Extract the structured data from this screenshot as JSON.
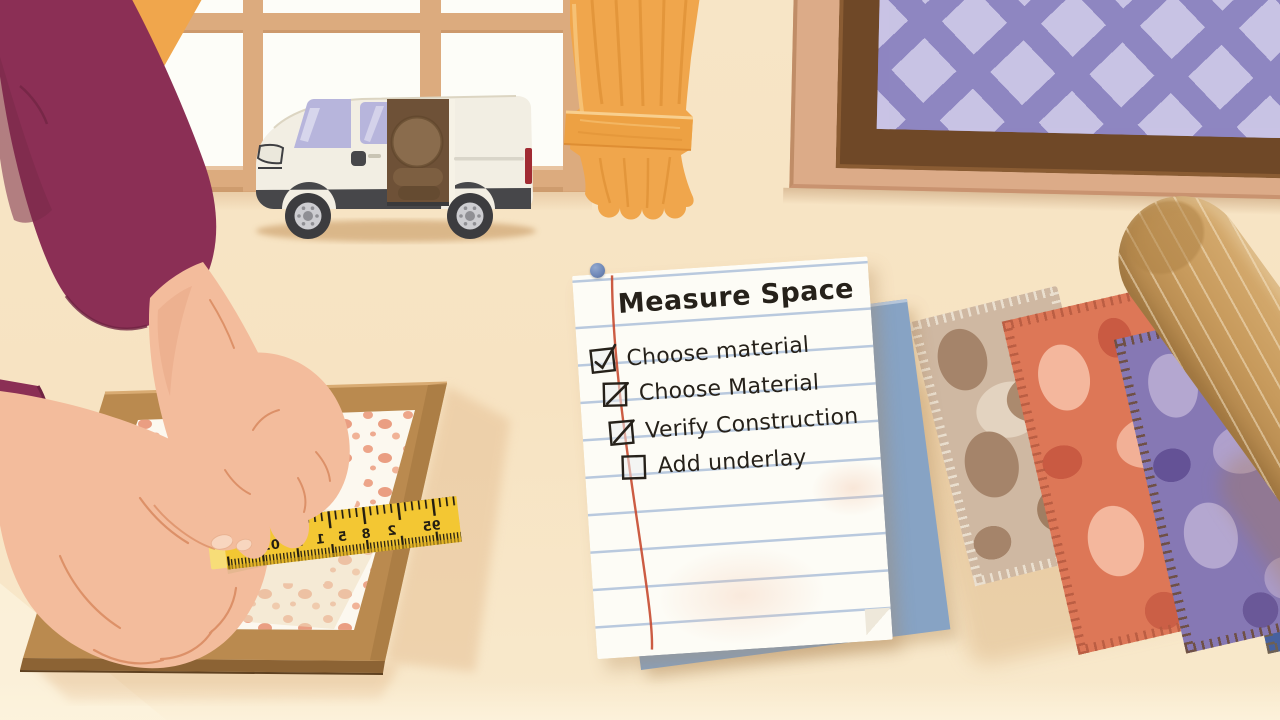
{
  "note": {
    "title": "Measure Space",
    "items": [
      {
        "label": "Choose material",
        "state": "checked"
      },
      {
        "label": "Choose Material",
        "state": "slash"
      },
      {
        "label": "Verify Construction",
        "state": "slash"
      },
      {
        "label": "Add underlay",
        "state": "empty"
      }
    ]
  },
  "tape": {
    "numbers": [
      "5",
      "01",
      "3",
      "1",
      "5",
      "8",
      "2",
      "95"
    ]
  },
  "colors": {
    "wall": "#f7e5c6",
    "window_pane": "#fdfdf8",
    "mullion": "#dcab7e",
    "curtain": "#f0a64c",
    "sleeve": "#8b2f55",
    "skin": "#f3bc9c",
    "board": "#ba8a4f",
    "rug_white": "#fcf8ef",
    "speckle": "#eb9d7f",
    "tape_yellow": "#f3c733",
    "van_body": "#f2eee3",
    "van_dark": "#47474a",
    "van_window": "#b7b5dc",
    "van_interior": "#6e5137",
    "taillight": "#a12b33",
    "paper": "#fdfcf6",
    "rule_line": "#b9c9de",
    "margin_line": "#c74a30",
    "pin": "#6d86b6",
    "ink": "#26211a",
    "frame_wood": "#6f4827",
    "frame_mat": "#dcab88",
    "frame_rug_purple": "#8e86c1",
    "frame_rug_diamond": "#cbc6e6",
    "sample_beige": "#cfb8a2",
    "sample_coral": "#dd7757",
    "sample_purple": "#8678b4",
    "sample_blue": "#47619e",
    "roll_tan": "#c79a5c",
    "underlay_blue": "#87a3c4"
  }
}
